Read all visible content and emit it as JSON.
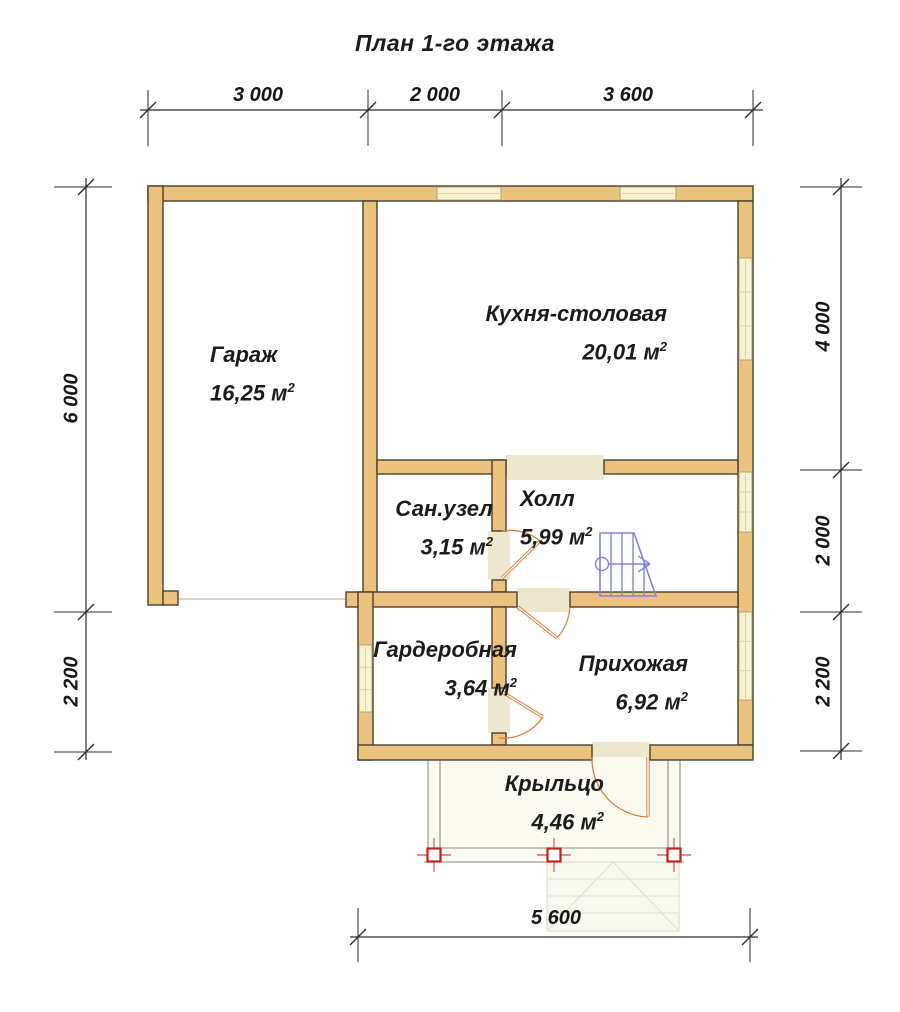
{
  "title": "План 1-го этажа",
  "rooms": [
    {
      "id": "garage",
      "name": "Гараж",
      "area": "16,25",
      "unit": " м",
      "sup": "2"
    },
    {
      "id": "kitchen",
      "name": "Кухня-столовая",
      "area": "20,01",
      "unit": " м",
      "sup": "2"
    },
    {
      "id": "bathroom",
      "name": "Сан.узел",
      "area": "3,15",
      "unit": " м",
      "sup": "2"
    },
    {
      "id": "hall",
      "name": "Холл",
      "area": "5,99",
      "unit": " м",
      "sup": "2"
    },
    {
      "id": "wardrobe",
      "name": "Гардеробная",
      "area": "3,64",
      "unit": " м",
      "sup": "2"
    },
    {
      "id": "entryway",
      "name": "Прихожая",
      "area": "6,92",
      "unit": " м",
      "sup": "2"
    },
    {
      "id": "porch",
      "name": "Крыльцо",
      "area": "4,46",
      "unit": " м",
      "sup": "2"
    }
  ],
  "dimensions": {
    "top": [
      "3 000",
      "2 000",
      "3 600"
    ],
    "left": [
      "6 000",
      "2 200"
    ],
    "right": [
      "4 000",
      "2 000",
      "2 200"
    ],
    "bottom": [
      "5 600"
    ]
  },
  "colors": {
    "wall_fill": "#ecc27f",
    "wall_stroke": "#46402f",
    "window_fill": "#f8f3d8",
    "window_stroke": "#b4a35f",
    "window_inner": "#ddd29a",
    "floor_fill": "#ece7cd",
    "door_orange": "#e0762f",
    "stair_blue": "#7f85d9",
    "post_red": "#c1221c",
    "porch_line": "#8c8c79",
    "porch_fill": "#fcfbf1",
    "steps_line": "#dfe0c6",
    "steps_fill": "#f8f9ee",
    "dim_color": "#2b2b2b",
    "faint_line": "#d9d5c2"
  }
}
